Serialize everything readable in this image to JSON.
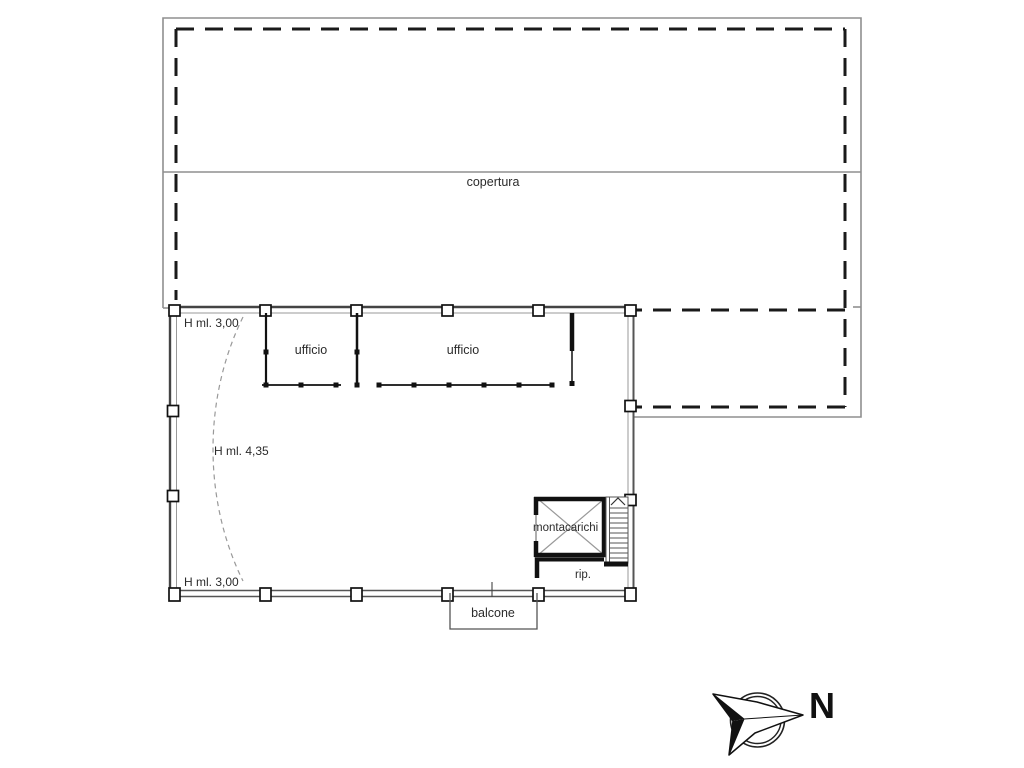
{
  "drawing": {
    "roof_label": "copertura",
    "rooms": {
      "office1": "ufficio",
      "office2": "ufficio",
      "elevator": "montacarichi",
      "storage": "rip.",
      "balcony": "balcone"
    },
    "heights": {
      "top": "H ml. 3,00",
      "middle": "H ml. 4,35",
      "bottom": "H ml. 3,00"
    },
    "compass": {
      "north_label": "N"
    },
    "colors": {
      "ink": "#1a1a1a",
      "wall_grey": "#555555",
      "light_grey": "#8f8f8f",
      "background": "#ffffff"
    }
  }
}
